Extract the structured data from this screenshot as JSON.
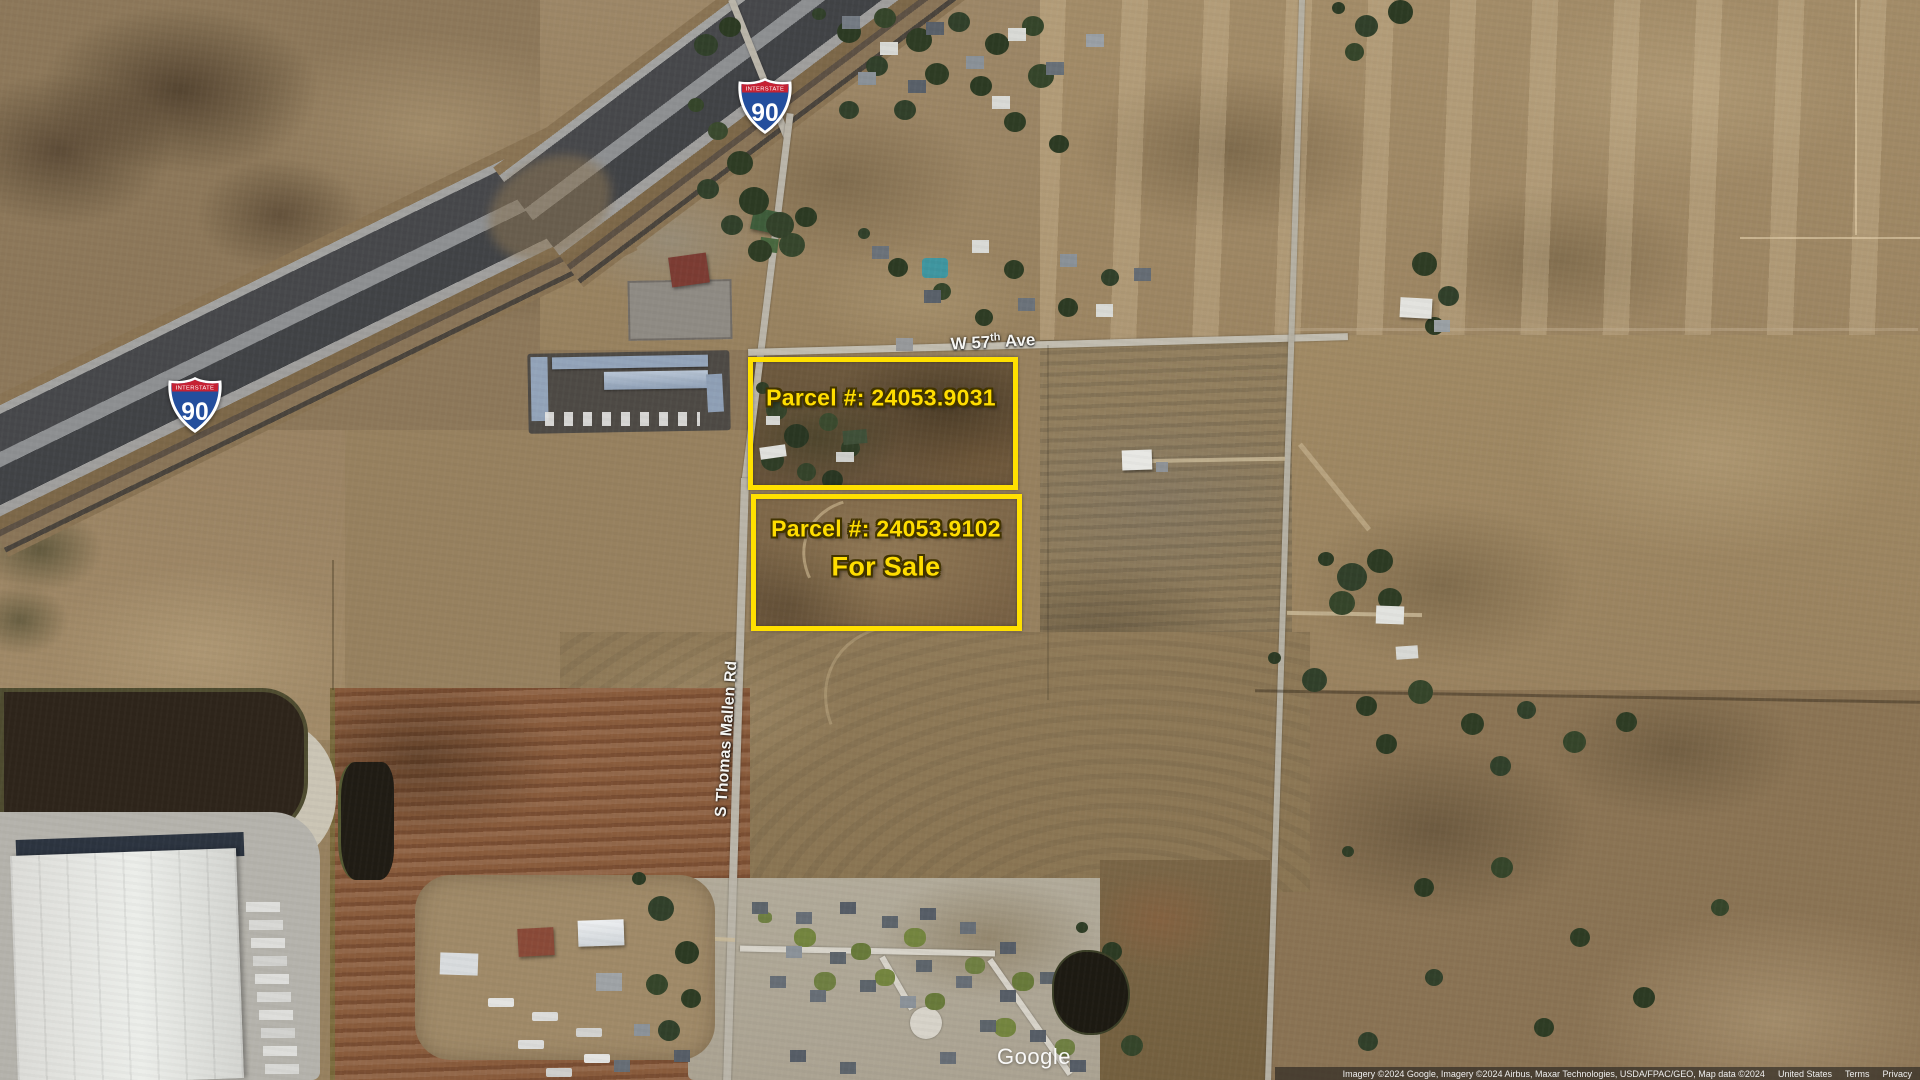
{
  "map": {
    "watermark": "Google",
    "attribution": [
      "Imagery ©2024 Google, Imagery ©2024 Airbus, Maxar Technologies, USDA/FPAC/GEO, Map data ©2024",
      "United States",
      "Terms",
      "Privacy"
    ]
  },
  "highway_shield": {
    "header": "INTERSTATE",
    "number": "90"
  },
  "road_labels": {
    "w57": {
      "prefix": "W 57",
      "superscript": "th",
      "suffix": " Ave"
    },
    "thomas_mallen": "S Thomas Mallen Rd"
  },
  "parcels": [
    {
      "label": "Parcel #: 24053.9031"
    },
    {
      "label": "Parcel #: 24053.9102",
      "status": "For Sale"
    }
  ],
  "colors": {
    "annotation_yellow": "#FFE000",
    "shield_blue": "#234E9D",
    "shield_red": "#C62233",
    "label_white": "#F5F5F2"
  }
}
